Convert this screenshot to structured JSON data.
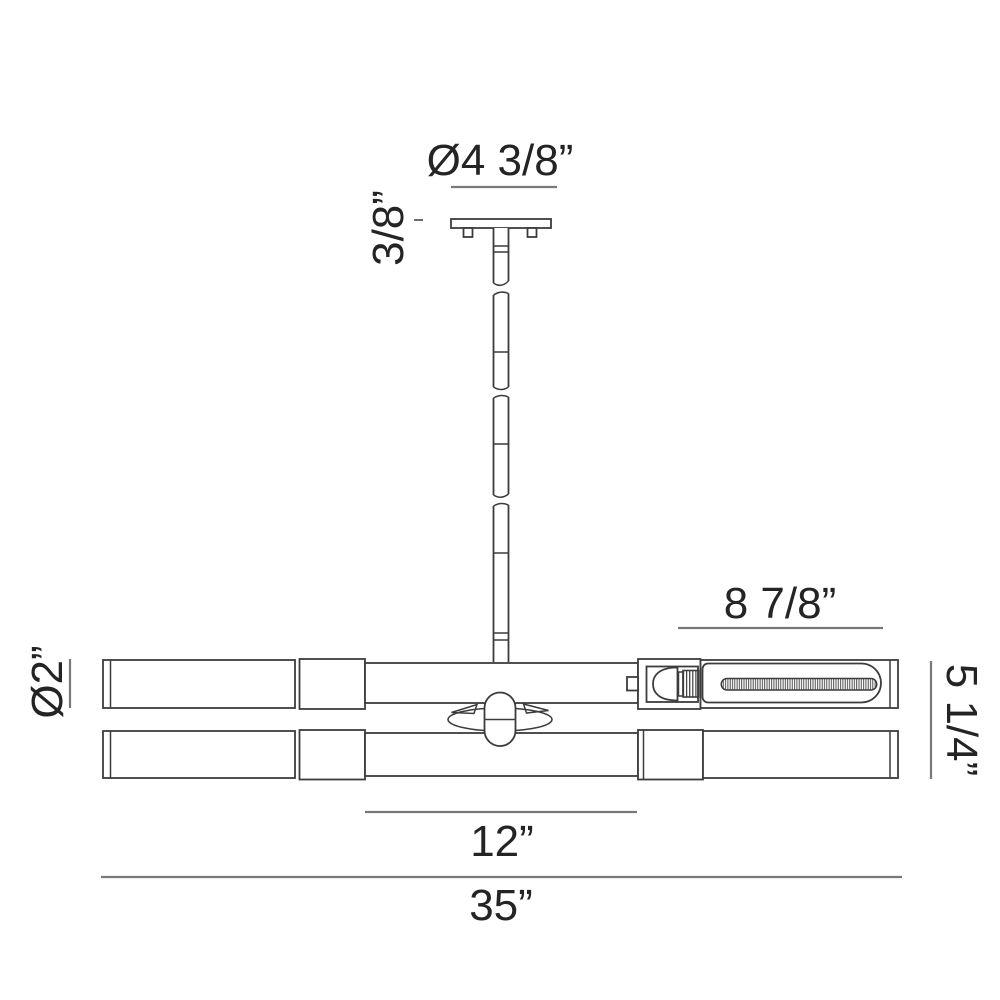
{
  "drawing": {
    "type": "technical-dimension-drawing",
    "subject": "two-tier linear pendant light fixture, front elevation",
    "background_color": "#ffffff",
    "line_color": "#3c3c3c",
    "dimension_line_color": "#787878",
    "text_color": "#242424",
    "dimensions": {
      "canopy_diameter": "Ø4 3/8”",
      "canopy_height": "3/8”",
      "lamp_section_length": "8 7/8”",
      "tube_diameter": "Ø2”",
      "body_height": "5 1/4”",
      "center_span": "12”",
      "overall_width": "35”"
    }
  }
}
